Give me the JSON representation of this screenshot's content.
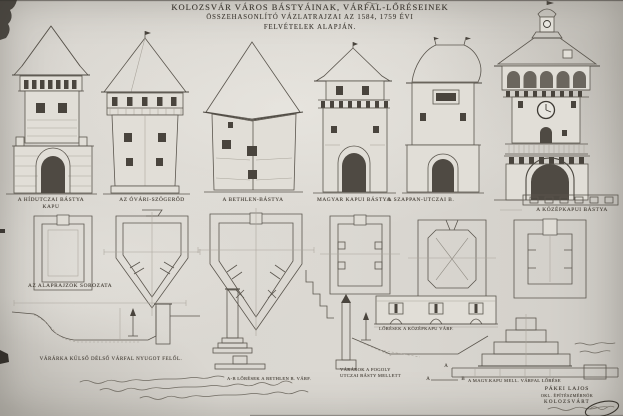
{
  "colors": {
    "paper": "#d9d6d0",
    "ink": "#4a443c",
    "pencil": "#6a655d",
    "dark_artifact": "#332f2a"
  },
  "title": {
    "line1": "KOLOZSVÁR VÁROS BÁSTYÁINAK, VÁRFAL-LŐRÉSEINEK",
    "line2": "ÖSSZEHASONLÍTÓ VÁZLATRAJZAI AZ 1584, 1759 ÉVI",
    "line3": "FELVÉTELEK ALAPJÁN."
  },
  "towers": [
    {
      "label_line1": "A HÍDUTCZAI BÁSTYA",
      "label_line2": "KAPU"
    },
    {
      "label_line1": "AZ ÓVÁRI-SZÖGERŐD",
      "label_line2": ""
    },
    {
      "label_line1": "A BETHLEN-BÁSTYA",
      "label_line2": ""
    },
    {
      "label_line1": "MAGYAR KAPUI BÁSTYA",
      "label_line2": ""
    },
    {
      "label_line1": "A SZAPPAN-UTCZAI B.",
      "label_line2": ""
    },
    {
      "label_line1": "A KÖZÉPKAPUI BÁSTYA",
      "label_line2": ""
    }
  ],
  "plans": {
    "series_label": "AZ ALAPRAJZOK SOROZATA"
  },
  "sections": {
    "moat_west_label": "VÁRÁRKA KÜLSŐ DÉLSŐ VÁRFAL NYUGOT FELŐL.",
    "loopholes_label": "LŐRÉSEK A KÖZÉPKAPU VÁRF.",
    "bethlen_section_label": "A-B LŐRÉSEK A BETHLEN B. VÁRF.",
    "fogoly_moat_line1": "VÁRÁROK A FOGOLY",
    "fogoly_moat_line2": "UTCZAI BÁSTY MELLETT",
    "marker_a": "A",
    "marker_b": "B",
    "magyar_gate_label": "A MAGY.KAPU MELL. VÁRFAL LŐRÉSE"
  },
  "signature": {
    "name": "PÁKEI LAJOS",
    "title": "OKL. ÉPÍTÉSZMÉRNÖK",
    "city": "KOLOZSVÁRT"
  }
}
